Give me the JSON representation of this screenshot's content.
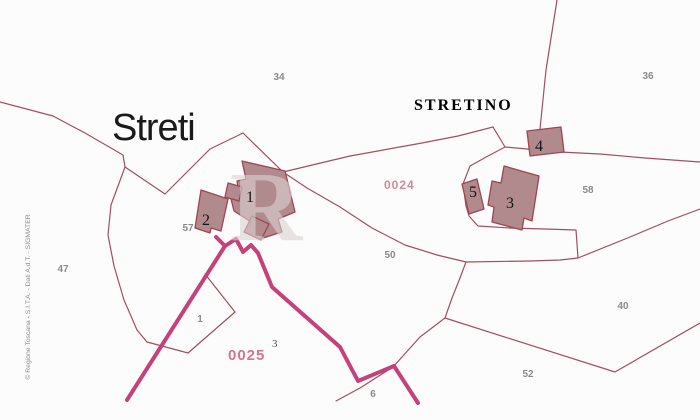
{
  "map": {
    "place_names": {
      "streti": "Streti",
      "stretino": "STRETINO"
    },
    "zone_codes": {
      "code_0024": "0024",
      "code_0025": "0025",
      "code_0025_sup": "3"
    },
    "building_numbers": {
      "b1": "1",
      "b2": "2",
      "b3": "3",
      "b4": "4",
      "b5": "5"
    },
    "parcel_numbers": {
      "p34": "34",
      "p36": "36",
      "p47": "47",
      "p50": "50",
      "p57": "57",
      "p58": "58",
      "p40": "40",
      "p52": "52",
      "p1": "1",
      "p6": "6"
    },
    "watermark": "R",
    "credit": "© Regione Toscana - S.I.T.A. - Dati A.d.T. - SIGMATER",
    "colors": {
      "background": "#fdfcfc",
      "boundary_line": "#a14e60",
      "road_line": "#c5417a",
      "building_fill": "#b18a8e",
      "building_stroke": "#a04450",
      "parcel_label_gray": "#8a8a8a",
      "zone_code_pink": "#d4879c",
      "place_text": "#1a1a1a"
    }
  }
}
